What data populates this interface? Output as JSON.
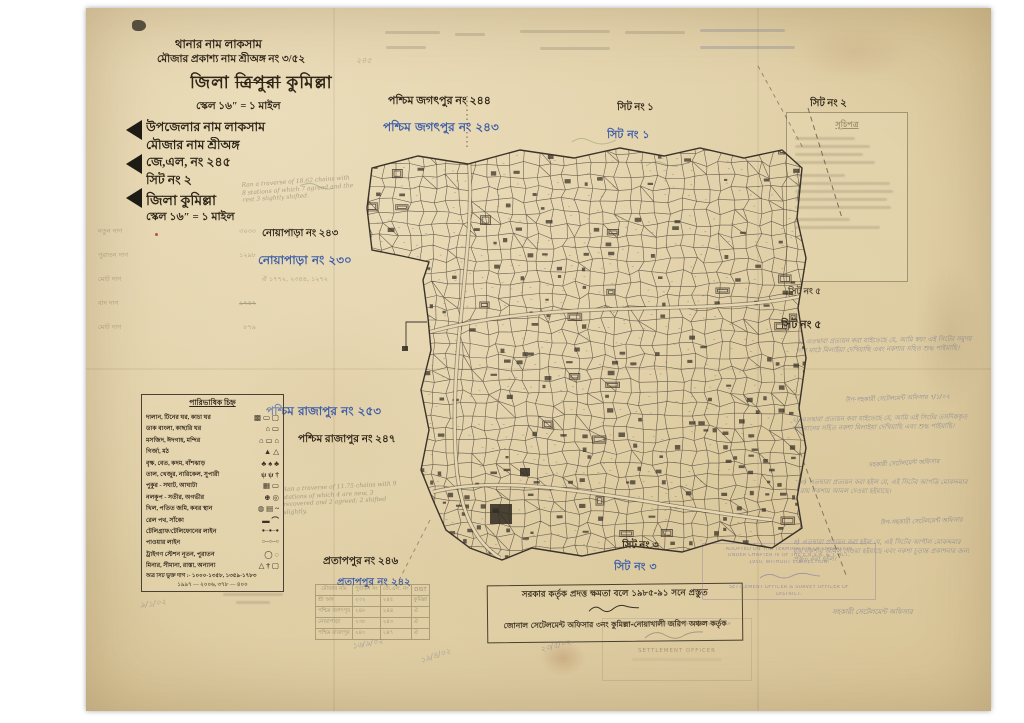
{
  "header": {
    "thana_line": "থানার নাম লাকসাম",
    "mouza_line": "মৌজার প্রকাশ্য নাম শ্রীঅঙ্গ নং ৩/৫২",
    "mouza_extra": "২৪৫",
    "district_prefix": "জিলা",
    "district_struck": "ত্রিপুরা",
    "district_suffix": "কুমিল্লা",
    "scale_line": "স্কেল ১৬″ = ১ মাইল"
  },
  "info_block": {
    "rows": [
      "উপজেলার নাম লাকসাম",
      "মৌজার নাম শ্রীঅঙ্গ",
      "জে,এল, নং ২৪৫",
      "সিট নং   ২",
      "জিলা  কুমিল্লা",
      "স্কেল ১৬″ = ১ মাইল"
    ]
  },
  "ledger": {
    "rows": [
      {
        "label": "নতুন দাগ",
        "value": "৩০৩৩"
      },
      {
        "label": "পুরাতন দাগ",
        "value": "১২৯৮"
      },
      {
        "label": "মোট দাগ",
        "value": "ঐ ১৭৭২, ২৩৪৪, ১২৭২"
      },
      {
        "label": "বাদ দাগ",
        "value": "৯৭৫৭"
      },
      {
        "label": "মোট দাগ",
        "value": "৮৭৯"
      }
    ]
  },
  "neighbors": {
    "top_black": "পশ্চিম জগৎপুর নং ২৪৪",
    "top_blue": "পশ্চিম জগৎপুর নং ২৪৩",
    "noyapara_black": "নোয়াপাড়া নং ২৪৩",
    "noyapara_blue": "নোয়াপাড়া নং ২৩০",
    "rajapur_blue": "পশ্চিম রাজাপুর নং ২৫৩",
    "rajapur_black": "পশ্চিম রাজাপুর নং ২৪৭",
    "pratappur_black": "প্রতাপপুর নং ২৪৬",
    "pratappur_blue": "প্রতাপপুর নং ২৪২"
  },
  "sheets": {
    "sheet1_black": "সিট নং ১",
    "sheet1_blue": "সিট নং ১",
    "sheet3_black": "সিট নং ৩",
    "sheet3_blue": "সিট নং ৩",
    "sheet2_right": "সিট নং ২",
    "sheet5_small": "সিট নং ৫",
    "sheet5_bold": "সিট নং ৫"
  },
  "legend": {
    "title": "পারিভাষিক চিহ্ন",
    "rows": [
      {
        "label": "দালান, টিনের ঘর, কাচা ঘর",
        "symbols": "▩ ▭ ▢"
      },
      {
        "label": "ডাক বাংলা, কাছারি ঘর",
        "symbols": "⌂ ▭"
      },
      {
        "label": "মসজিদ, ঈদগাহ, মন্দির",
        "symbols": "⌂ ▭ ⌂"
      },
      {
        "label": "গির্জা, মঠ",
        "symbols": "▲ △"
      },
      {
        "label": "বৃক্ষ, বেত, কদম, বাঁশঝাড়",
        "symbols": "♣ ♠ ♣"
      },
      {
        "label": "তাল, খেজুর, নারিকেল, সুপারী",
        "symbols": "ψ ψ †"
      },
      {
        "label": "পুকুর - সঘাট, আঘাটা",
        "symbols": "▦ ▭"
      },
      {
        "label": "নলকূপ - সতীর, অগভীর",
        "symbols": "⊕ ◎"
      },
      {
        "label": "খিল, পতিত জমি, কবর স্থান",
        "symbols": "◍ ▤ ~"
      },
      {
        "label": "রেল পথ, সাঁকো",
        "symbols": "▬ ⌒"
      },
      {
        "label": "টেলিগ্রাফ/টেলিফোনের লাইন",
        "symbols": "●--●--●"
      },
      {
        "label": "পাওয়ার লাইন",
        "symbols": "○--○--○"
      },
      {
        "label": "ট্রাইগণ স্টেশন নূতন, পুরাতন",
        "symbols": "◯ ◌"
      },
      {
        "label": "মিনার, সীমানা, রাস্তা, অন্যান্য",
        "symbols": "△ † ▢"
      }
    ],
    "footer1": "অত্র সিট ভুক্ত দাগ :- ১০০০-১৩৫৮, ১৩৫৯-১৭৮৩",
    "footer2": "১৯৯৭ — ২০০৬,  ৩৭৮ — ৪০০"
  },
  "index_box": {
    "title": "সূচিপত্র"
  },
  "notes": {
    "items": [
      {
        "text": "১) এতদ্বারা প্রত্যয়ন করা যাইতেছে যে, আমি স্বয়ং এই সিটের সমুদয় দাগ মাঠে মিলাইয়া দেখিয়াছি এবং নকশার সহিত শুদ্ধ পাইয়াছি।",
        "sig": "উপ-সহকারী সেটেলমেন্ট অফিসার  ৭/১/০২"
      },
      {
        "text": "২) এতদ্বারা প্রত্যয়ন করা যাইতেছে যে, আমি এই সিটের তসদিককৃত খতিয়ানের সহিত নকশা মিলাইয়া দেখিয়াছি এবং শুদ্ধ পাইয়াছি।",
        "sig": "সহকারী সেটেলমেন্ট অফিসার"
      },
      {
        "text": "৩) এতদ্বারা প্রত্যয়ন করা হইল যে, এই সিটের আপত্তি মোকদ্দমার রায় নকশায় আমল দেওয়া হইয়াছে।",
        "sig": "উপ-সহকারী সেটেলমেন্ট অফিসার"
      },
      {
        "text": "৪) এতদ্বারা প্রত্যয়ন করা হইল যে, এই সিটের আপীল মোকদ্দমার রায় নকশায় আমল দেওয়া হইয়াছে এবং নকশা চূড়ান্ত প্রকাশনার জন্য প্রস্তুত করা হইল।",
        "sig": "সহকারী সেটেলমেন্ট অফিসার"
      }
    ]
  },
  "pencil_notes": {
    "note_top": "Ran a traverse of 18.62 chains with 8 stations of which 7 agreed and the rest 3 slightly shifted.",
    "note_mid": "Ran a traverse of 11.75 chains with 9 stations of which 4 are new, 3 recovered and 2 agreed; 2 shifted slightly."
  },
  "table": {
    "headers": [
      "মৌজার নাম",
      "পুরাতন নং",
      "জে.এল. নং",
      "DIST"
    ],
    "rows": [
      [
        "শ্রী অঙ্গ",
        "২৩২",
        "২৪৫",
        "কুমিল্লা"
      ],
      [
        "পশ্চিম জগৎপুর",
        "২৪৮",
        "২৪৪",
        "ঐ"
      ],
      [
        "নোয়াপাড়া",
        "২৩৮",
        "২৪৩",
        "ঐ"
      ],
      [
        "পশ্চিম রাজাপুর",
        "২৪০",
        "২৪৭",
        "ঐ"
      ]
    ]
  },
  "stamps": {
    "english": {
      "lines": [
        "ADOPTED ON THE TERMINATION OF OPERATION",
        "UNDER CHAPTER IV OF THE E.B.S.A. & T. ACT,",
        "1950, WITHOUT CORRECTION.",
        "SETTLEMENT OFFICER & SURVEY OFFICER OF",
        "DISTRICT."
      ]
    },
    "bengali": {
      "line1": "সরকার কর্তৃক প্রদত্ত ক্ষমতা বলে ১৯৮৫-৯১ সনে প্রস্তুত",
      "line2": "জোনাল সেটেলমেন্ট অফিসার ৩নং কুমিল্লা-নোয়াখালী জরিপ অঞ্চল কর্তৃক"
    },
    "made_by": {
      "line1": "MADE BY THE AUTHORITY OF GOVERNMENT OF",
      "line2": "SETTLEMENT OFFICER"
    }
  },
  "signatures": {
    "s1": "৯/১/০২",
    "s2": "১৬/৯/০২",
    "s3": "১৯/৪/০২",
    "s4": "২৩/৫/০২"
  }
}
